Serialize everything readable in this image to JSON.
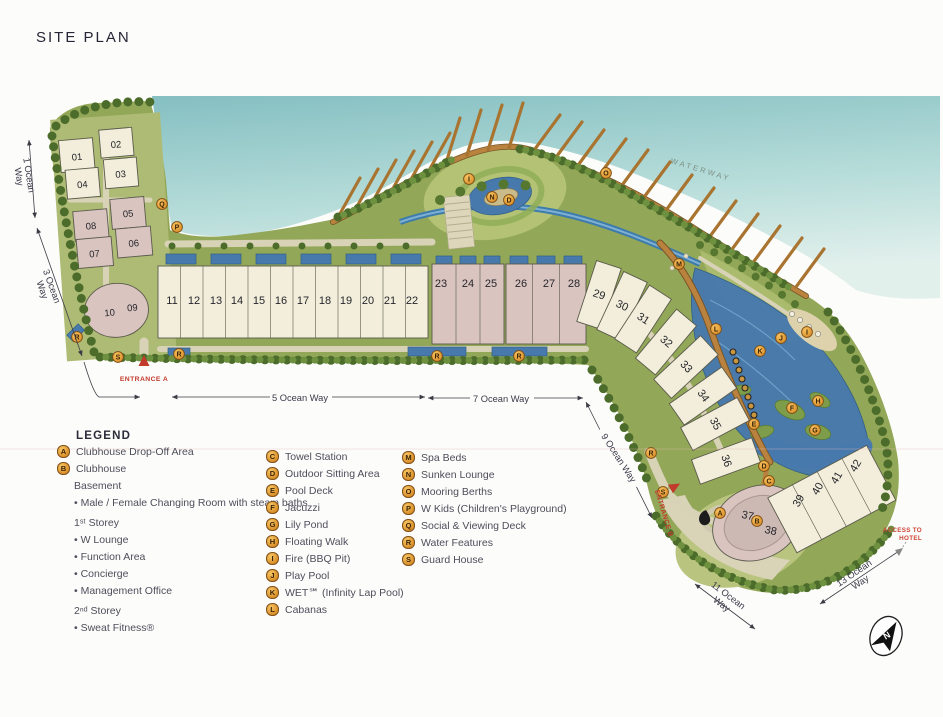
{
  "title": "SITE PLAN",
  "legend": {
    "heading": "LEGEND",
    "a": {
      "key": "A",
      "label": "Clubhouse Drop-Off Area"
    },
    "b": {
      "key": "B",
      "label": "Clubhouse"
    },
    "basement": "Basement",
    "basement_items": [
      "Male / Female Changing Room with steam baths"
    ],
    "storey1": "1ˢᵗ Storey",
    "storey1_items": [
      "W Lounge",
      "Function Area",
      "Concierge",
      "Management Office"
    ],
    "storey2": "2ⁿᵈ Storey",
    "storey2_items": [
      "Sweat Fitness®"
    ],
    "col2": [
      {
        "key": "C",
        "label": "Towel Station"
      },
      {
        "key": "D",
        "label": "Outdoor Sitting Area"
      },
      {
        "key": "E",
        "label": "Pool Deck"
      },
      {
        "key": "F",
        "label": "Jacuzzi"
      },
      {
        "key": "G",
        "label": "Lily Pond"
      },
      {
        "key": "H",
        "label": "Floating Walk"
      },
      {
        "key": "I",
        "label": "Fire (BBQ Pit)"
      },
      {
        "key": "J",
        "label": "Play Pool"
      },
      {
        "key": "K",
        "label": "WET℠ (Infinity Lap Pool)"
      },
      {
        "key": "L",
        "label": "Cabanas"
      }
    ],
    "col3": [
      {
        "key": "M",
        "label": "Spa Beds"
      },
      {
        "key": "N",
        "label": "Sunken Lounge"
      },
      {
        "key": "O",
        "label": "Mooring Berths"
      },
      {
        "key": "P",
        "label": "W Kids (Children's Playground)"
      },
      {
        "key": "Q",
        "label": "Social & Viewing Deck"
      },
      {
        "key": "R",
        "label": "Water Features"
      },
      {
        "key": "S",
        "label": "Guard House"
      }
    ]
  },
  "map": {
    "buildings": [
      "01",
      "02",
      "03",
      "04",
      "05",
      "06",
      "07",
      "08",
      "09",
      "10",
      "11",
      "12",
      "13",
      "14",
      "15",
      "16",
      "17",
      "18",
      "19",
      "20",
      "21",
      "22",
      "23",
      "24",
      "25",
      "26",
      "27",
      "28",
      "29",
      "30",
      "31",
      "32",
      "33",
      "34",
      "35",
      "36",
      "37",
      "38",
      "39",
      "40",
      "41",
      "42"
    ],
    "markers": [
      "Q",
      "P",
      "R",
      "S",
      "R",
      "R",
      "R",
      "I",
      "N",
      "D",
      "O",
      "M",
      "L",
      "K",
      "J",
      "I",
      "F",
      "H",
      "G",
      "E",
      "R",
      "S",
      "A",
      "B",
      "D",
      "C"
    ],
    "streets": {
      "w1a": "1 Ocean",
      "w1b": "Way",
      "w3a": "3 Ocean",
      "w3b": "Way",
      "w5": "5 Ocean Way",
      "w7": "7 Ocean Way",
      "w9": "9 Ocean Way",
      "w11a": "11 Ocean",
      "w11b": "Way",
      "w13a": "13 Ocean",
      "w13b": "Way"
    },
    "labels": {
      "entrance_a": "ENTRANCE A",
      "entrance_b": "ENTRANCE B",
      "waterway": "WATERWAY",
      "access_line1": "ACCESS TO",
      "access_line2": "HOTEL",
      "north": "N"
    }
  },
  "colors": {
    "water": "#85bfc2",
    "land": "#93a758",
    "building_cream": "#f2eedb",
    "building_pink": "#d9c4c0",
    "pool_blue": "#4779ad",
    "boardwalk": "#b9833f",
    "marker_orange": "#e49a33",
    "accent_red": "#c13a2c",
    "ink": "#3a3a4a"
  }
}
